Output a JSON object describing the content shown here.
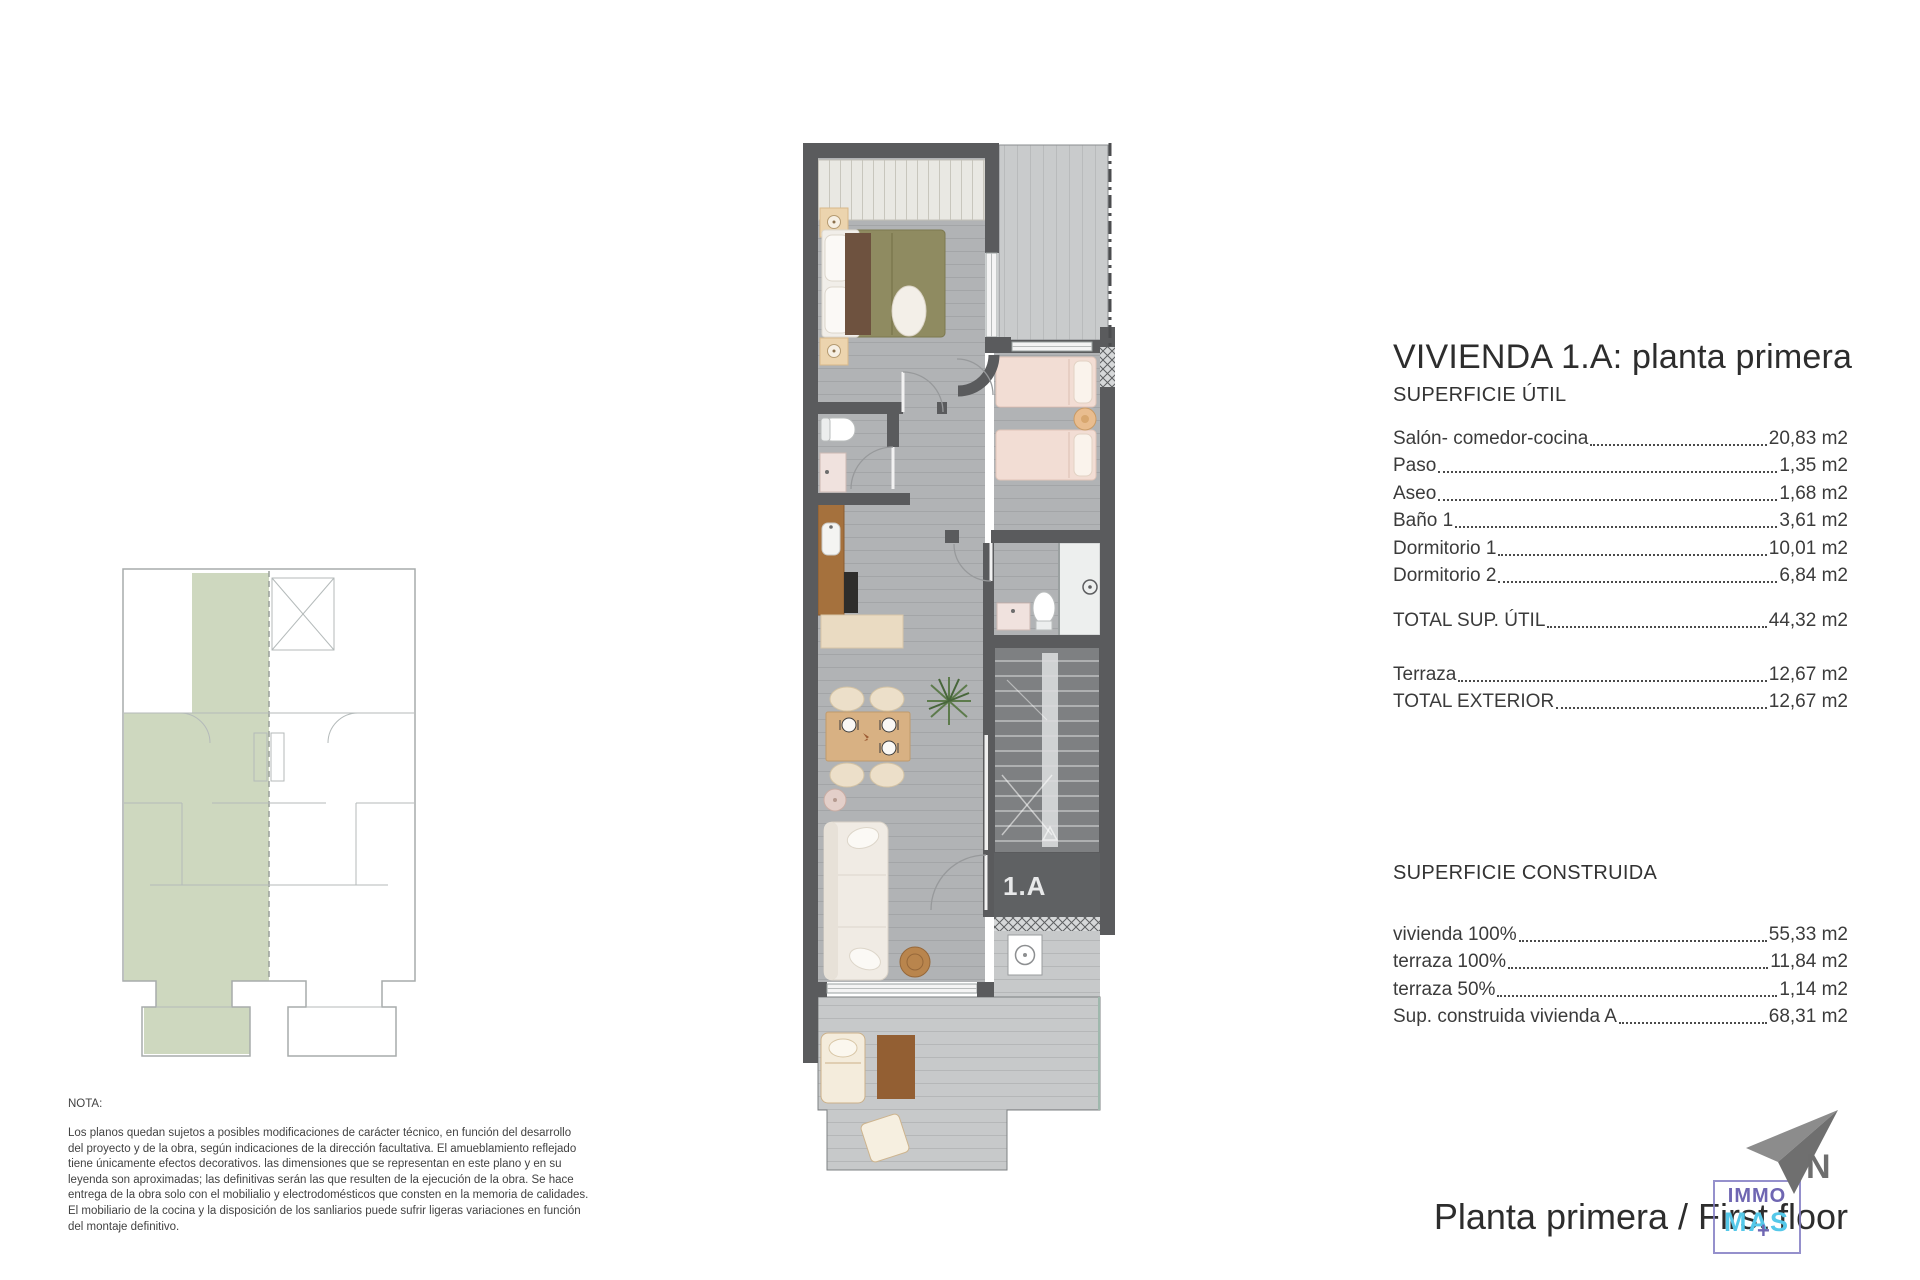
{
  "title_block": {
    "title": "VIVIENDA 1.A: planta primera",
    "util": {
      "heading": "SUPERFICIE ÚTIL",
      "rows": [
        {
          "label": "Salón- comedor-cocina",
          "value": "20,83 m2"
        },
        {
          "label": "Paso",
          "value": "1,35 m2"
        },
        {
          "label": "Aseo",
          "value": "1,68 m2"
        },
        {
          "label": "Baño 1",
          "value": "3,61 m2"
        },
        {
          "label": "Dormitorio 1",
          "value": "10,01 m2"
        },
        {
          "label": "Dormitorio 2",
          "value": "6,84 m2"
        }
      ],
      "total": {
        "label": "TOTAL SUP. ÚTIL",
        "value": "44,32 m2"
      },
      "exterior": [
        {
          "label": "Terraza",
          "value": "12,67 m2"
        },
        {
          "label": "TOTAL EXTERIOR",
          "value": "12,67 m2"
        }
      ]
    },
    "construida": {
      "heading": "SUPERFICIE CONSTRUIDA",
      "rows": [
        {
          "label": "vivienda 100%",
          "value": "55,33 m2"
        },
        {
          "label": "terraza 100%",
          "value": "11,84 m2"
        },
        {
          "label": "terraza 50%",
          "value": "1,14 m2"
        },
        {
          "label": "Sup. construida vivienda A",
          "value": "68,31 m2"
        }
      ]
    }
  },
  "nota": {
    "heading": "NOTA:",
    "lines": [
      "Los planos quedan sujetos a posibles modificaciones de carácter técnico, en función del desarrollo",
      "del proyecto y de la obra, según indicaciones de la dirección facultativa. El amueblamiento reflejado",
      "tiene únicamente efectos decorativos. las dimensiones que se representan en este plano y en su",
      "leyenda son aproximadas; las definitivas serán las que resulten de la ejecución de la obra. Se hace",
      "entrega de la obra solo con el mobilialio y electrodomésticos que consten en la memoria de calidades.",
      "El mobiliario de la cocina y la disposición de los sanliarios puede sufrir ligeras variaciones en función",
      "del montaje definitivo."
    ]
  },
  "plan": {
    "unit_label": "1.A",
    "colors": {
      "wall": "#5a5b5d",
      "floor": "#b1b3b5",
      "terrace_floor": "#c9cbcc",
      "stairs": "#7e8082",
      "bed_olive": "#8f8b61",
      "bed_pink": "#f2ddd4",
      "wood_counter": "#a5713d",
      "wood_table": "#d8b183",
      "sofa_cream": "#f0ebe4",
      "plant_green": "#5d7b4c"
    }
  },
  "key_plan": {
    "highlight_color": "#ced8bf"
  },
  "footer": {
    "caption": "Planta primera / First floor",
    "north_label": "N",
    "logo": {
      "top": "IMMO",
      "bottom": "MAS",
      "plus": "+",
      "purple": "#6f66b2",
      "cyan": "#55c8e9"
    }
  }
}
